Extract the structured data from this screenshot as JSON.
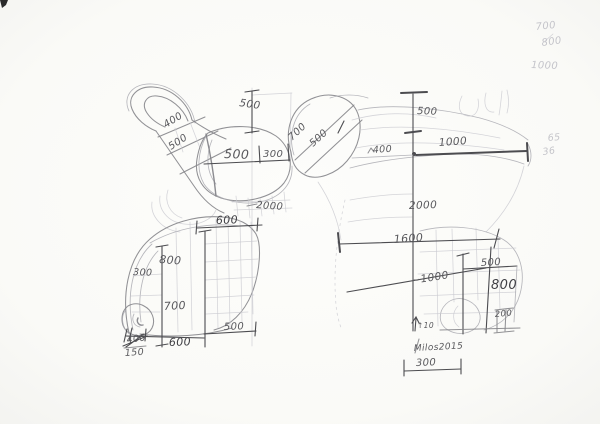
{
  "document": {
    "title": "Pencil dimension sketch of two sculptural figures",
    "medium": "hand-drawn pencil on paper"
  },
  "palette": {
    "paper": "#fafaf7",
    "pencil": "#85858a",
    "pencil_light": "#a9a9b0",
    "pencil_faint": "#c9c9cf",
    "pencil_dark": "#4c4c50",
    "label": "#58585c",
    "label_dark": "#3f3f44",
    "label_faint": "#c4c4ca"
  },
  "left_figure": {
    "dims": {
      "top_height": "500",
      "back_upper": "400",
      "back_lower": "500",
      "seat_width": "500",
      "seat_depth": "300",
      "overall_height": "2000"
    }
  },
  "base_figure": {
    "dims": {
      "top_width": "600",
      "inner_height": "800",
      "side_depth": "300",
      "lower_height": "700",
      "bottom_right_width": "500",
      "bottom_width": "600",
      "struck_value": "400",
      "foot_offset": "150"
    }
  },
  "right_figure": {
    "dims": {
      "head_diagonal": "700",
      "head_diagonal_b": "500",
      "top_height": "500",
      "neck_offset": "400",
      "arm_reach": "1000",
      "overall_height": "2000",
      "overall_width": "1600",
      "diagonal": "~1000",
      "leg_width": "500",
      "leg_height": "800",
      "foot_height": "200",
      "ground_mark": "↑10",
      "base_width": "300"
    },
    "signature": "Milos2015"
  },
  "margin_notes": {
    "n1": "700",
    "n2": "800",
    "n3": "1000",
    "n4": "65",
    "n5": "36"
  }
}
